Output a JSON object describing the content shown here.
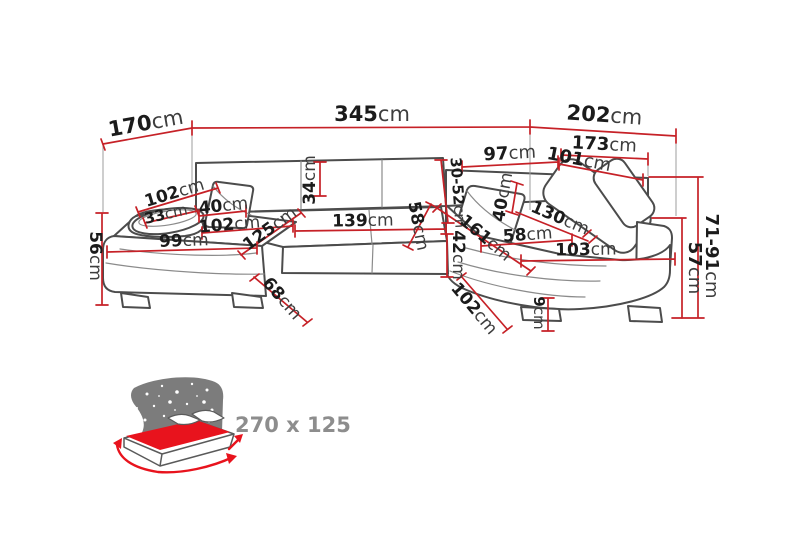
{
  "diagram": {
    "type": "furniture-dimension-diagram",
    "colors": {
      "dimension_red": "#c62127",
      "outline_gray": "#4c4c4c",
      "label_black": "#1b1b1b",
      "icon_gray": "#7c7c7c",
      "icon_red": "#e8131d",
      "icon_text_gray": "#8d8d8d"
    },
    "labels": {
      "d170": {
        "value": "170",
        "unit": "cm"
      },
      "d345": {
        "value": "345",
        "unit": "cm"
      },
      "d202": {
        "value": "202",
        "unit": "cm"
      },
      "d173": {
        "value": "173",
        "unit": "cm"
      },
      "d97": {
        "value": "97",
        "unit": "cm"
      },
      "d101": {
        "value": "101",
        "unit": "cm"
      },
      "d3052": {
        "value": "30-52",
        "unit": "cm"
      },
      "d34": {
        "value": "34",
        "unit": "cm"
      },
      "d102ul": {
        "value": "102",
        "unit": "cm"
      },
      "d33": {
        "value": "33",
        "unit": "cm"
      },
      "d40l": {
        "value": "40",
        "unit": "cm"
      },
      "d102l": {
        "value": "102",
        "unit": "cm"
      },
      "d99": {
        "value": "99",
        "unit": "cm"
      },
      "d125": {
        "value": "125",
        "unit": "cm"
      },
      "d139": {
        "value": "139",
        "unit": "cm"
      },
      "d58m": {
        "value": "58",
        "unit": "cm"
      },
      "d42": {
        "value": "42",
        "unit": "cm"
      },
      "d161": {
        "value": "161",
        "unit": "cm"
      },
      "d40r": {
        "value": "40",
        "unit": "cm"
      },
      "d130": {
        "value": "130",
        "unit": "cm"
      },
      "d58r": {
        "value": "58",
        "unit": "cm"
      },
      "d103": {
        "value": "103",
        "unit": "cm"
      },
      "d102br": {
        "value": "102",
        "unit": "cm"
      },
      "d9": {
        "value": "9",
        "unit": "cm"
      },
      "d68": {
        "value": "68",
        "unit": "cm"
      },
      "d56": {
        "value": "56",
        "unit": "cm"
      },
      "d7191": {
        "value": "71-91",
        "unit": "cm"
      },
      "d57": {
        "value": "57",
        "unit": "cm"
      }
    },
    "sleeping_area": {
      "label": "270 x 125"
    }
  }
}
